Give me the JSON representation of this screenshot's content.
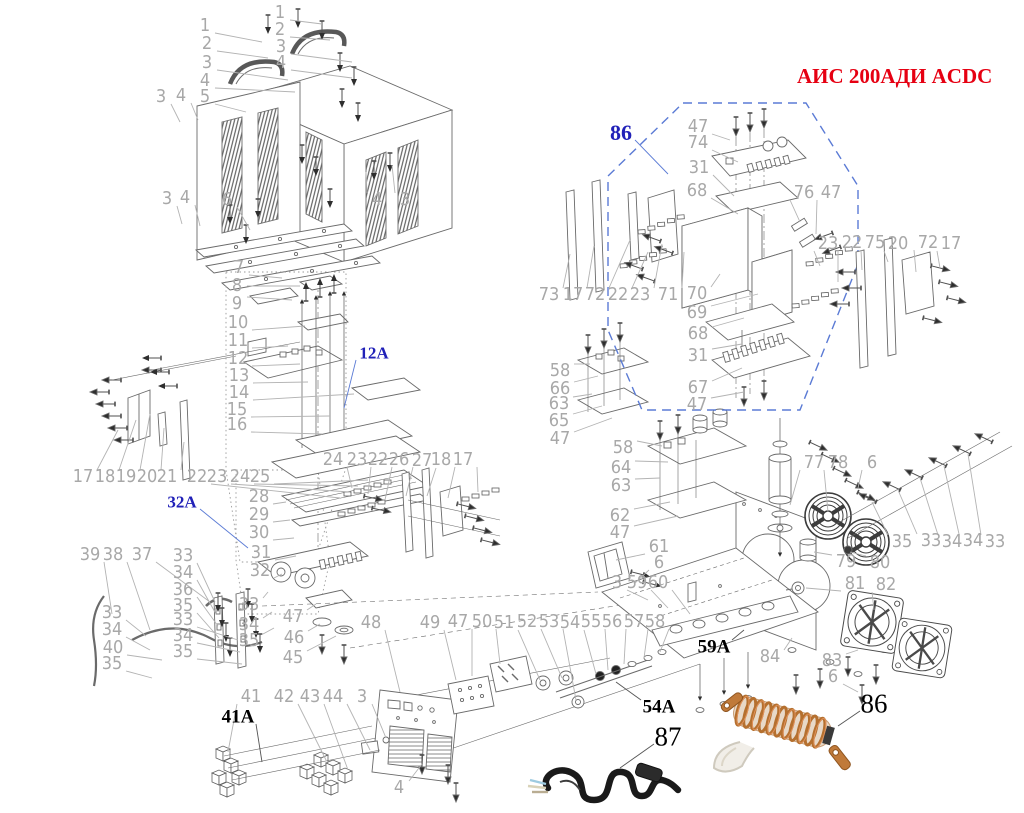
{
  "title": "АИС 200АДИ ACDC",
  "colors": {
    "title": "#e60012",
    "section_label": "#2121b8",
    "callout": "#a8a8a8",
    "region_86_border": "#5b7bd5",
    "coil_copper": "#b5702f",
    "cable_black": "#1a1a1a"
  },
  "callouts": [
    {
      "t": "1",
      "x": 205,
      "y": 26,
      "tx": 262,
      "ty": 42
    },
    {
      "t": "2",
      "x": 207,
      "y": 44,
      "tx": 268,
      "ty": 58
    },
    {
      "t": "3",
      "x": 207,
      "y": 63,
      "tx": 288,
      "ty": 80
    },
    {
      "t": "4",
      "x": 205,
      "y": 81,
      "tx": 295,
      "ty": 92
    },
    {
      "t": "5",
      "x": 205,
      "y": 97,
      "tx": 246,
      "ty": 112
    },
    {
      "t": "1",
      "x": 280,
      "y": 13,
      "tx": 322,
      "ty": 24
    },
    {
      "t": "2",
      "x": 280,
      "y": 30,
      "tx": 330,
      "ty": 40
    },
    {
      "t": "3",
      "x": 281,
      "y": 47,
      "tx": 352,
      "ty": 62
    },
    {
      "t": "4",
      "x": 281,
      "y": 63,
      "tx": 352,
      "ty": 78
    },
    {
      "t": "3",
      "x": 161,
      "y": 97,
      "tx": 180,
      "ty": 122
    },
    {
      "t": "4",
      "x": 181,
      "y": 96,
      "tx": 198,
      "ty": 120
    },
    {
      "t": "3",
      "x": 167,
      "y": 199,
      "tx": 182,
      "ty": 224
    },
    {
      "t": "4",
      "x": 185,
      "y": 198,
      "tx": 200,
      "ty": 226
    },
    {
      "t": "6",
      "x": 227,
      "y": 200,
      "tx": 250,
      "ty": 230
    },
    {
      "t": "4",
      "x": 377,
      "y": 200,
      "tx": 366,
      "ty": 172
    },
    {
      "t": "3",
      "x": 405,
      "y": 200,
      "tx": 392,
      "ty": 165
    },
    {
      "t": "7",
      "x": 239,
      "y": 268,
      "tx": 282,
      "ty": 278
    },
    {
      "t": "8",
      "x": 237,
      "y": 286,
      "tx": 300,
      "ty": 286
    },
    {
      "t": "9",
      "x": 237,
      "y": 304,
      "tx": 292,
      "ty": 300
    },
    {
      "t": "10",
      "x": 238,
      "y": 323,
      "tx": 305,
      "ty": 326
    },
    {
      "t": "11",
      "x": 238,
      "y": 341,
      "tx": 288,
      "ty": 346
    },
    {
      "t": "12",
      "x": 238,
      "y": 359,
      "tx": 300,
      "ty": 364
    },
    {
      "t": "13",
      "x": 239,
      "y": 376,
      "tx": 308,
      "ty": 382
    },
    {
      "t": "14",
      "x": 239,
      "y": 393,
      "tx": 354,
      "ty": 394
    },
    {
      "t": "15",
      "x": 237,
      "y": 410,
      "tx": 330,
      "ty": 416
    },
    {
      "t": "16",
      "x": 237,
      "y": 425,
      "tx": 322,
      "ty": 434
    },
    {
      "t": "17",
      "x": 83,
      "y": 477,
      "tx": 118,
      "ty": 430
    },
    {
      "t": "18",
      "x": 105,
      "y": 477,
      "tx": 136,
      "ty": 420
    },
    {
      "t": "19",
      "x": 126,
      "y": 477,
      "tx": 150,
      "ty": 414
    },
    {
      "t": "20",
      "x": 147,
      "y": 477,
      "tx": 164,
      "ty": 428
    },
    {
      "t": "21",
      "x": 167,
      "y": 477,
      "tx": 184,
      "ty": 442
    },
    {
      "t": "22",
      "x": 197,
      "y": 477,
      "tx": 340,
      "ty": 498
    },
    {
      "t": "23",
      "x": 217,
      "y": 477,
      "tx": 350,
      "ty": 492
    },
    {
      "t": "24",
      "x": 240,
      "y": 477,
      "tx": 358,
      "ty": 486
    },
    {
      "t": "25",
      "x": 260,
      "y": 477,
      "tx": 368,
      "ty": 480
    },
    {
      "t": "24",
      "x": 333,
      "y": 460,
      "tx": 352,
      "ty": 488
    },
    {
      "t": "23",
      "x": 357,
      "y": 460,
      "tx": 368,
      "ty": 494
    },
    {
      "t": "22",
      "x": 378,
      "y": 460,
      "tx": 385,
      "ty": 500
    },
    {
      "t": "26",
      "x": 399,
      "y": 460,
      "tx": 406,
      "ty": 496
    },
    {
      "t": "27",
      "x": 422,
      "y": 461,
      "tx": 427,
      "ty": 496
    },
    {
      "t": "18",
      "x": 441,
      "y": 460,
      "tx": 448,
      "ty": 498
    },
    {
      "t": "17",
      "x": 463,
      "y": 460,
      "tx": 478,
      "ty": 492
    },
    {
      "t": "28",
      "x": 259,
      "y": 497,
      "tx": 286,
      "ty": 502
    },
    {
      "t": "29",
      "x": 259,
      "y": 515,
      "tx": 290,
      "ty": 520
    },
    {
      "t": "30",
      "x": 259,
      "y": 533,
      "tx": 294,
      "ty": 538
    },
    {
      "t": "31",
      "x": 261,
      "y": 553,
      "tx": 296,
      "ty": 556
    },
    {
      "t": "32",
      "x": 260,
      "y": 571,
      "tx": 282,
      "ty": 574
    },
    {
      "t": "39",
      "x": 90,
      "y": 555,
      "tx": 112,
      "ty": 614
    },
    {
      "t": "38",
      "x": 113,
      "y": 555,
      "tx": 150,
      "ty": 630
    },
    {
      "t": "37",
      "x": 142,
      "y": 555,
      "tx": 210,
      "ty": 602
    },
    {
      "t": "33",
      "x": 183,
      "y": 556,
      "tx": 215,
      "ty": 602
    },
    {
      "t": "34",
      "x": 183,
      "y": 573,
      "tx": 216,
      "ty": 614
    },
    {
      "t": "36",
      "x": 183,
      "y": 590,
      "tx": 218,
      "ty": 626
    },
    {
      "t": "35",
      "x": 183,
      "y": 606,
      "tx": 219,
      "ty": 638
    },
    {
      "t": "33",
      "x": 183,
      "y": 620,
      "tx": 238,
      "ty": 640
    },
    {
      "t": "34",
      "x": 183,
      "y": 636,
      "tx": 240,
      "ty": 652
    },
    {
      "t": "35",
      "x": 183,
      "y": 652,
      "tx": 242,
      "ty": 664
    },
    {
      "t": "33",
      "x": 112,
      "y": 613,
      "tx": 146,
      "ty": 636
    },
    {
      "t": "34",
      "x": 112,
      "y": 630,
      "tx": 150,
      "ty": 650
    },
    {
      "t": "40",
      "x": 113,
      "y": 648,
      "tx": 162,
      "ty": 660
    },
    {
      "t": "35",
      "x": 112,
      "y": 664,
      "tx": 152,
      "ty": 678
    },
    {
      "t": "33",
      "x": 249,
      "y": 605,
      "tx": 268,
      "ty": 592
    },
    {
      "t": "34",
      "x": 249,
      "y": 625,
      "tx": 272,
      "ty": 612
    },
    {
      "t": "35",
      "x": 249,
      "y": 641,
      "tx": 274,
      "ty": 628
    },
    {
      "t": "47",
      "x": 293,
      "y": 617,
      "tx": 316,
      "ty": 604
    },
    {
      "t": "46",
      "x": 294,
      "y": 638,
      "tx": 320,
      "ty": 624
    },
    {
      "t": "45",
      "x": 293,
      "y": 658,
      "tx": 336,
      "ty": 636
    },
    {
      "t": "48",
      "x": 371,
      "y": 623,
      "tx": 400,
      "ty": 692
    },
    {
      "t": "49",
      "x": 430,
      "y": 623,
      "tx": 456,
      "ty": 680
    },
    {
      "t": "47",
      "x": 458,
      "y": 622,
      "tx": 472,
      "ty": 676
    },
    {
      "t": "50",
      "x": 482,
      "y": 622,
      "tx": 500,
      "ty": 664
    },
    {
      "t": "51",
      "x": 504,
      "y": 623,
      "tx": 540,
      "ty": 680
    },
    {
      "t": "52",
      "x": 527,
      "y": 622,
      "tx": 562,
      "ty": 678
    },
    {
      "t": "53",
      "x": 549,
      "y": 622,
      "tx": 576,
      "ty": 700
    },
    {
      "t": "54",
      "x": 570,
      "y": 623,
      "tx": 596,
      "ty": 674
    },
    {
      "t": "55",
      "x": 591,
      "y": 622,
      "tx": 608,
      "ty": 670
    },
    {
      "t": "56",
      "x": 612,
      "y": 622,
      "tx": 624,
      "ty": 664
    },
    {
      "t": "57",
      "x": 634,
      "y": 622,
      "tx": 644,
      "ty": 658
    },
    {
      "t": "58",
      "x": 655,
      "y": 622,
      "tx": 660,
      "ty": 652
    },
    {
      "t": "41",
      "x": 251,
      "y": 697,
      "tx": 228,
      "ty": 752
    },
    {
      "t": "42",
      "x": 284,
      "y": 697,
      "tx": 326,
      "ty": 760
    },
    {
      "t": "43",
      "x": 310,
      "y": 697,
      "tx": 348,
      "ty": 770
    },
    {
      "t": "44",
      "x": 333,
      "y": 697,
      "tx": 370,
      "ty": 750
    },
    {
      "t": "3",
      "x": 362,
      "y": 697,
      "tx": 386,
      "ty": 738
    },
    {
      "t": "4",
      "x": 399,
      "y": 788,
      "tx": 422,
      "ty": 764
    },
    {
      "t": "3",
      "x": 617,
      "y": 583,
      "tx": 648,
      "ty": 600
    },
    {
      "t": "59",
      "x": 637,
      "y": 583,
      "tx": 668,
      "ty": 608
    },
    {
      "t": "60",
      "x": 658,
      "y": 583,
      "tx": 690,
      "ty": 614
    },
    {
      "t": "61",
      "x": 659,
      "y": 547,
      "tx": 616,
      "ty": 560
    },
    {
      "t": "6",
      "x": 659,
      "y": 563,
      "tx": 634,
      "ty": 584
    },
    {
      "t": "58",
      "x": 560,
      "y": 371,
      "tx": 590,
      "ty": 364
    },
    {
      "t": "66",
      "x": 560,
      "y": 389,
      "tx": 598,
      "ty": 376
    },
    {
      "t": "63",
      "x": 559,
      "y": 404,
      "tx": 592,
      "ty": 394
    },
    {
      "t": "65",
      "x": 559,
      "y": 421,
      "tx": 602,
      "ty": 406
    },
    {
      "t": "47",
      "x": 560,
      "y": 439,
      "tx": 612,
      "ty": 418
    },
    {
      "t": "58",
      "x": 623,
      "y": 448,
      "tx": 662,
      "ty": 446
    },
    {
      "t": "64",
      "x": 621,
      "y": 468,
      "tx": 668,
      "ty": 462
    },
    {
      "t": "63",
      "x": 621,
      "y": 486,
      "tx": 660,
      "ty": 478
    },
    {
      "t": "62",
      "x": 620,
      "y": 516,
      "tx": 670,
      "ty": 502
    },
    {
      "t": "47",
      "x": 620,
      "y": 533,
      "tx": 678,
      "ty": 516
    },
    {
      "t": "47",
      "x": 698,
      "y": 127,
      "tx": 730,
      "ty": 140
    },
    {
      "t": "74",
      "x": 698,
      "y": 143,
      "tx": 738,
      "ty": 162
    },
    {
      "t": "31",
      "x": 699,
      "y": 168,
      "tx": 734,
      "ty": 196
    },
    {
      "t": "68",
      "x": 697,
      "y": 191,
      "tx": 738,
      "ty": 214
    },
    {
      "t": "76",
      "x": 804,
      "y": 193,
      "tx": 800,
      "ty": 222
    },
    {
      "t": "47",
      "x": 831,
      "y": 193,
      "tx": 816,
      "ty": 234
    },
    {
      "t": "73",
      "x": 549,
      "y": 295,
      "tx": 570,
      "ty": 254
    },
    {
      "t": "17",
      "x": 573,
      "y": 295,
      "tx": 594,
      "ty": 246
    },
    {
      "t": "72",
      "x": 595,
      "y": 295,
      "tx": 630,
      "ty": 240
    },
    {
      "t": "22",
      "x": 618,
      "y": 295,
      "tx": 648,
      "ty": 252
    },
    {
      "t": "23",
      "x": 640,
      "y": 295,
      "tx": 662,
      "ty": 244
    },
    {
      "t": "71",
      "x": 668,
      "y": 295,
      "tx": 684,
      "ty": 252
    },
    {
      "t": "70",
      "x": 697,
      "y": 294,
      "tx": 720,
      "ty": 274
    },
    {
      "t": "69",
      "x": 697,
      "y": 313,
      "tx": 758,
      "ty": 294
    },
    {
      "t": "68",
      "x": 698,
      "y": 334,
      "tx": 744,
      "ty": 318
    },
    {
      "t": "31",
      "x": 698,
      "y": 356,
      "tx": 742,
      "ty": 344
    },
    {
      "t": "67",
      "x": 698,
      "y": 388,
      "tx": 742,
      "ty": 368
    },
    {
      "t": "47",
      "x": 697,
      "y": 405,
      "tx": 744,
      "ty": 392
    },
    {
      "t": "23",
      "x": 828,
      "y": 244,
      "tx": 820,
      "ty": 266
    },
    {
      "t": "22",
      "x": 852,
      "y": 243,
      "tx": 838,
      "ty": 282
    },
    {
      "t": "75",
      "x": 875,
      "y": 243,
      "tx": 862,
      "ty": 270
    },
    {
      "t": "20",
      "x": 898,
      "y": 244,
      "tx": 888,
      "ty": 262
    },
    {
      "t": "72",
      "x": 928,
      "y": 243,
      "tx": 916,
      "ty": 272
    },
    {
      "t": "17",
      "x": 951,
      "y": 244,
      "tx": 940,
      "ty": 268
    },
    {
      "t": "77",
      "x": 814,
      "y": 463,
      "tx": 790,
      "ty": 505
    },
    {
      "t": "78",
      "x": 838,
      "y": 463,
      "tx": 828,
      "ty": 512
    },
    {
      "t": "6",
      "x": 872,
      "y": 463,
      "tx": 858,
      "ty": 488
    },
    {
      "t": "35",
      "x": 902,
      "y": 542,
      "tx": 872,
      "ty": 502
    },
    {
      "t": "33",
      "x": 931,
      "y": 541,
      "tx": 898,
      "ty": 490
    },
    {
      "t": "34",
      "x": 952,
      "y": 542,
      "tx": 920,
      "ty": 478
    },
    {
      "t": "34",
      "x": 973,
      "y": 541,
      "tx": 944,
      "ty": 466
    },
    {
      "t": "33",
      "x": 995,
      "y": 542,
      "tx": 968,
      "ty": 454
    },
    {
      "t": "79",
      "x": 846,
      "y": 562,
      "tx": 814,
      "ty": 552
    },
    {
      "t": "80",
      "x": 880,
      "y": 563,
      "tx": 850,
      "ty": 552
    },
    {
      "t": "81",
      "x": 855,
      "y": 584,
      "tx": 806,
      "ty": 588
    },
    {
      "t": "82",
      "x": 886,
      "y": 585,
      "tx": 874,
      "ty": 610
    },
    {
      "t": "84",
      "x": 770,
      "y": 657,
      "tx": 792,
      "ty": 638
    },
    {
      "t": "83",
      "x": 832,
      "y": 661,
      "tx": 858,
      "ty": 650
    },
    {
      "t": "6",
      "x": 833,
      "y": 677,
      "tx": 858,
      "ty": 692
    },
    {
      "t": "41A",
      "x": 238,
      "y": 717,
      "cls": "blk",
      "tx": 262,
      "ty": 762
    },
    {
      "t": "54A",
      "x": 659,
      "y": 707,
      "cls": "blk",
      "tx": 616,
      "ty": 682
    },
    {
      "t": "59A",
      "x": 714,
      "y": 647,
      "cls": "blk",
      "tx": 744,
      "ty": 630
    },
    {
      "t": "87",
      "x": 668,
      "y": 737,
      "cls": "blk blk-lg",
      "tx": 620,
      "ty": 768
    },
    {
      "t": "86",
      "x": 874,
      "y": 704,
      "cls": "blk blk-lg",
      "tx": 838,
      "ty": 726
    },
    {
      "t": "86",
      "x": 621,
      "y": 133,
      "cls": "blue blue-lg",
      "tx": 668,
      "ty": 174
    },
    {
      "t": "12A",
      "x": 374,
      "y": 353,
      "cls": "blue",
      "tx": 344,
      "ty": 408
    },
    {
      "t": "32A",
      "x": 182,
      "y": 502,
      "cls": "blue",
      "tx": 248,
      "ty": 548
    }
  ]
}
